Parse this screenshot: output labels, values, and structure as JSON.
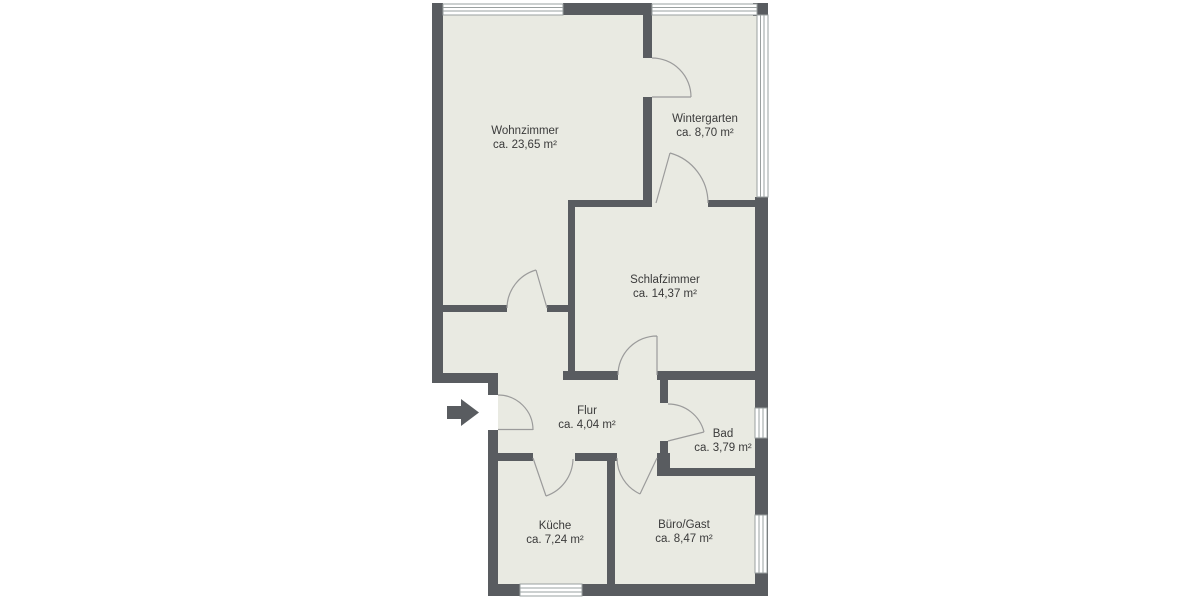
{
  "plan": {
    "title": "Grundriss / floor plan",
    "rooms": [
      {
        "id": "wohnzimmer",
        "name": "Wohnzimmer",
        "area": "ca. 23,65 m²"
      },
      {
        "id": "wintergarten",
        "name": "Wintergarten",
        "area": "ca. 8,70 m²"
      },
      {
        "id": "schlafzimmer",
        "name": "Schlafzimmer",
        "area": "ca. 14,37 m²"
      },
      {
        "id": "flur",
        "name": "Flur",
        "area": "ca. 4,04 m²"
      },
      {
        "id": "bad",
        "name": "Bad",
        "area": "ca. 3,79 m²"
      },
      {
        "id": "kueche",
        "name": "Küche",
        "area": "ca. 7,24 m²"
      },
      {
        "id": "buero_gast",
        "name": "Büro/Gast",
        "area": "ca. 8,47 m²"
      }
    ],
    "icons": [
      "entrance-arrow",
      "window",
      "door-swing"
    ],
    "colors": {
      "wall": "#595c60",
      "floor": "#e9eae2",
      "background": "#ffffff",
      "door_line": "#9b9b9b",
      "window_line": "#9aa0a0",
      "text": "#3a3a3a"
    }
  }
}
